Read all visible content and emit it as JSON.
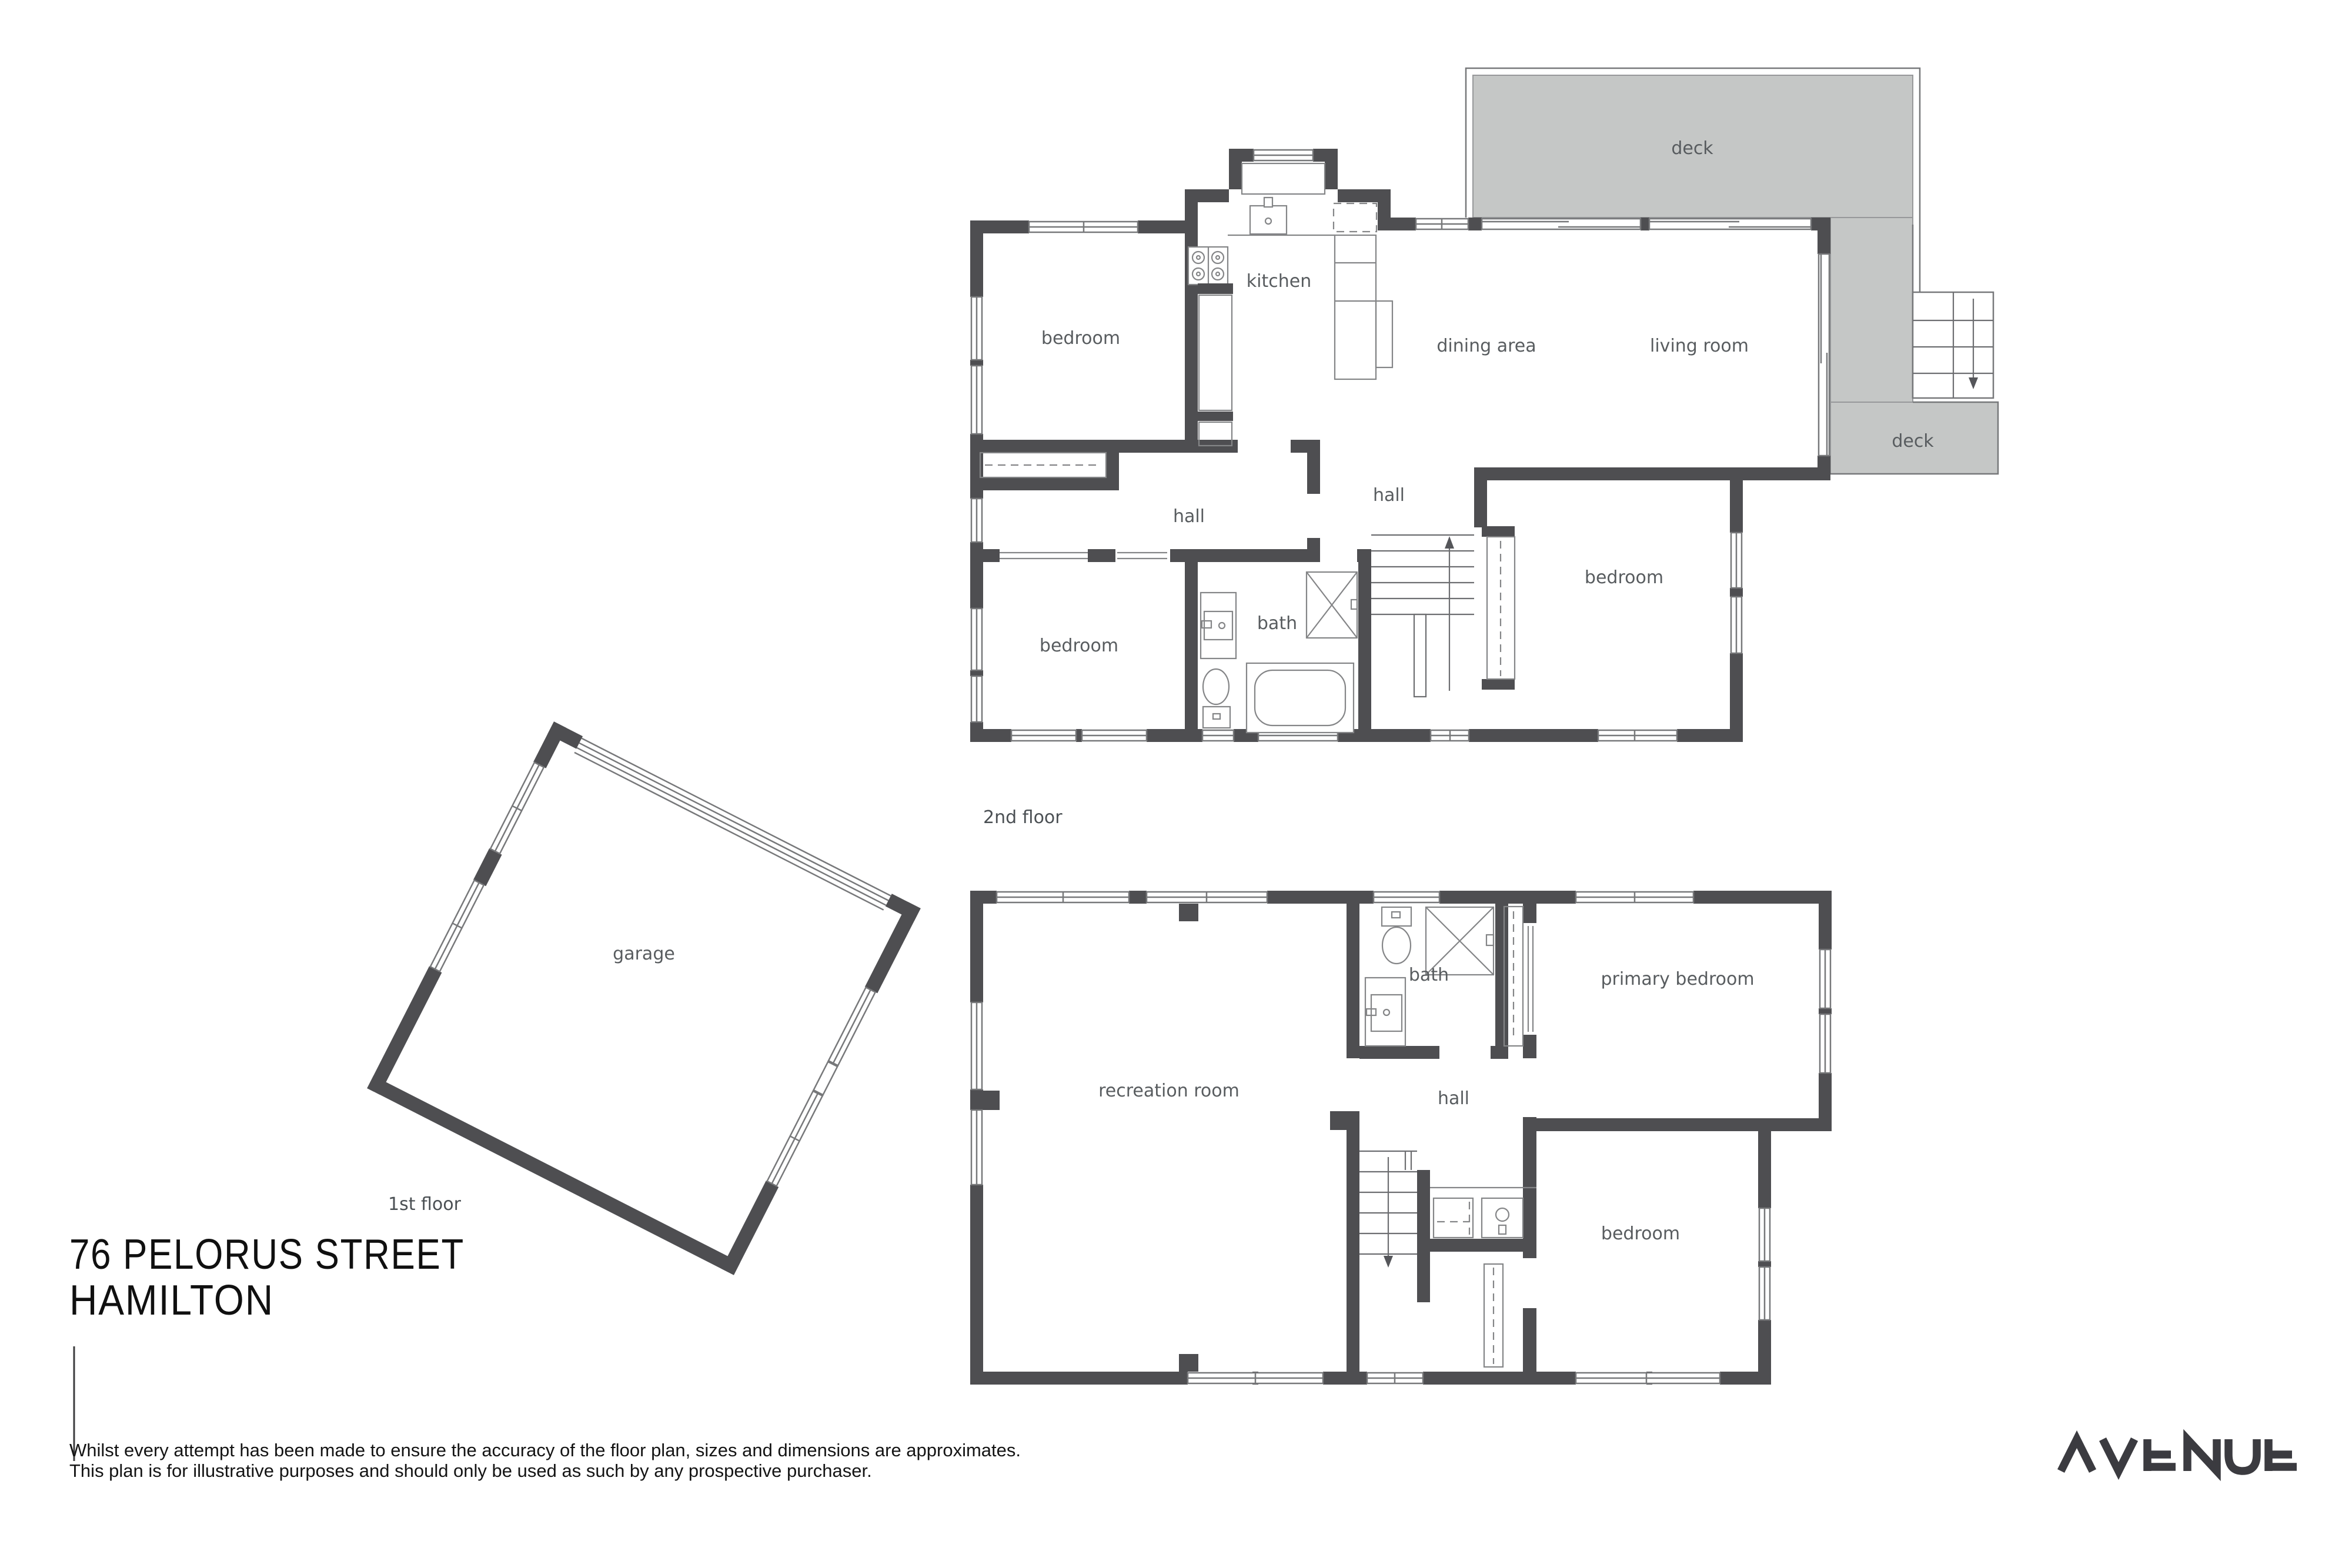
{
  "page": {
    "background": "#ffffff"
  },
  "title": {
    "line1": "76 PELORUS STREET",
    "line2": "HAMILTON"
  },
  "disclaimer": {
    "line1": "Whilst every attempt has been made to ensure the accuracy of the floor plan, sizes and dimensions are approximates.",
    "line2": "This plan is for illustrative purposes and should only be used as such by any prospective purchaser."
  },
  "brand": {
    "logo_text": "AVENUE"
  },
  "colors": {
    "wall": "#4e4e51",
    "deck_fill": "#c5c7c6",
    "thin_line": "#77787a",
    "room_label": "#585c5f",
    "title_text": "#101010",
    "logo": "#3b3b40"
  },
  "floor2": {
    "label": "2nd floor",
    "rooms": {
      "bedroom_top_left": "bedroom",
      "kitchen": "kitchen",
      "dining": "dining area",
      "living": "living room",
      "deck_top": "deck",
      "deck_side": "deck",
      "hall_left": "hall",
      "hall_right": "hall",
      "bath": "bath",
      "bedroom_bottom_left": "bedroom",
      "bedroom_bottom_right": "bedroom"
    }
  },
  "floor1": {
    "label": "1st floor",
    "rooms": {
      "recreation": "recreation room",
      "bath": "bath",
      "primary_bedroom": "primary bedroom",
      "hall": "hall",
      "bedroom": "bedroom",
      "garage": "garage"
    }
  }
}
